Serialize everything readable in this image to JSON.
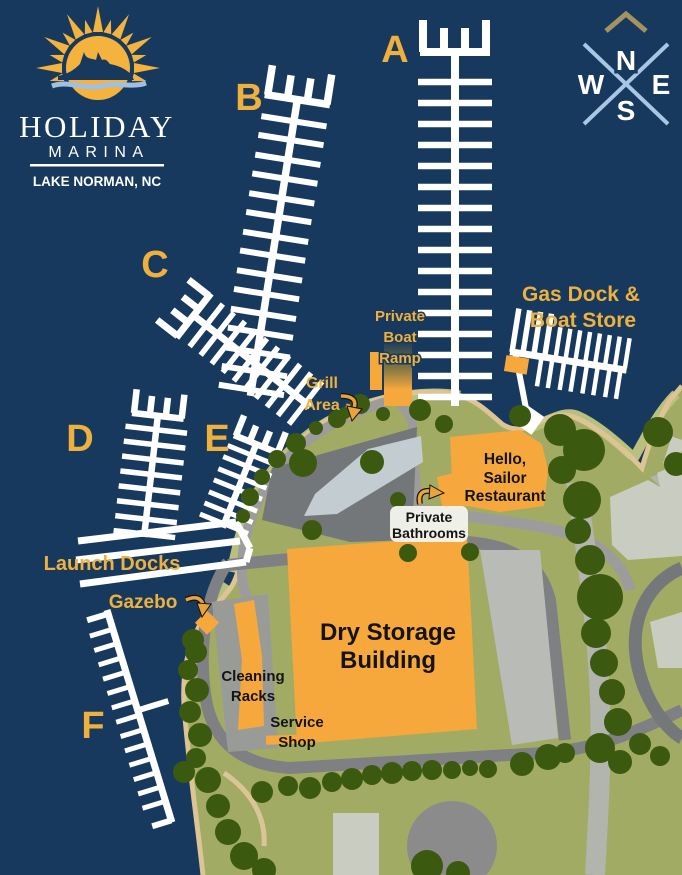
{
  "logo": {
    "name": "HOLIDAY",
    "type": "MARINA",
    "location": "LAKE NORMAN, NC"
  },
  "compass": {
    "north": "N",
    "east": "E",
    "south": "S",
    "west": "W"
  },
  "docks": {
    "a": "A",
    "b": "B",
    "c": "C",
    "d": "D",
    "e": "E",
    "f": "F"
  },
  "labels": {
    "private_boat_ramp": {
      "l1": "Private",
      "l2": "Boat",
      "l3": "Ramp"
    },
    "grill_area": {
      "l1": "Grill",
      "l2": "Area"
    },
    "gas_dock": {
      "l1": "Gas Dock &",
      "l2": "Boat Store"
    },
    "restaurant": {
      "l1": "Hello,",
      "l2": "Sailor",
      "l3": "Restaurant"
    },
    "private_bathrooms": {
      "l1": "Private",
      "l2": "Bathrooms"
    },
    "launch_docks": "Launch Docks",
    "gazebo": "Gazebo",
    "dry_storage": {
      "l1": "Dry Storage",
      "l2": "Building"
    },
    "cleaning_racks": {
      "l1": "Cleaning",
      "l2": "Racks"
    },
    "service_shop": {
      "l1": "Service",
      "l2": "Shop"
    }
  },
  "colors": {
    "water": "#17395E",
    "land": "#A2AB64",
    "shore_band": "#B9C07E",
    "shoreline": "#DCC494",
    "trees": "#3B5A10",
    "building_orange": "#F6A83C",
    "gold_text": "#EFB13E",
    "dock_white": "#FFFFFF",
    "road": "#9C9C9C",
    "road_dark": "#7E8083",
    "parking_dark": "#74777A",
    "parking_light": "#C2CCD1",
    "building_gray": "#C9CCC0",
    "black_text": "#141414",
    "compass_lines": "#A9C7E4",
    "compass_chevron": "#A4935E",
    "logo_sun": "#F3B33C",
    "logo_wave": "#9FC0E4"
  }
}
